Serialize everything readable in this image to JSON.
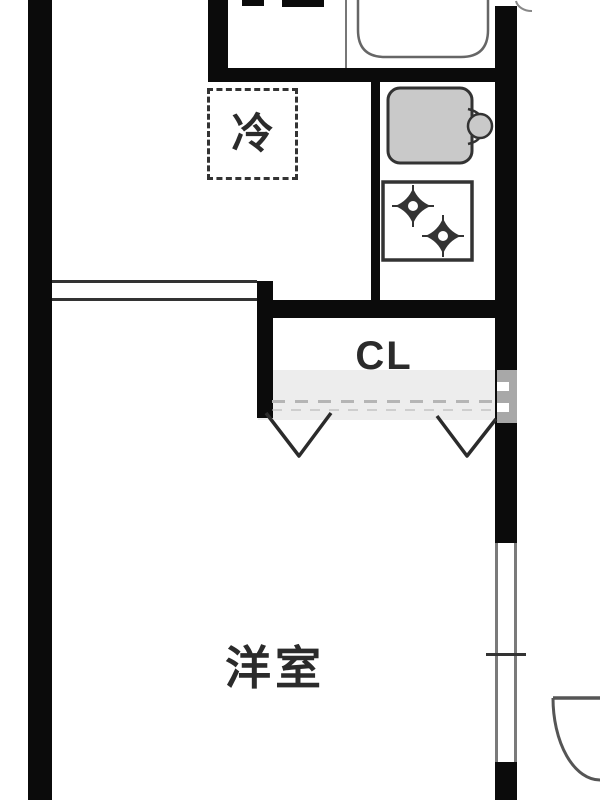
{
  "floorplan": {
    "rooms": {
      "western_room_label": "洋室",
      "closet_label": "CL",
      "refrigerator_label": "冷"
    },
    "fixtures": [
      "washbasin",
      "kitchen-sink",
      "two-burner-stove",
      "refrigerator-space",
      "closet-folding-doors",
      "window",
      "entry-door-swing"
    ],
    "colors": {
      "background": "#ffffff",
      "wall": "#0b0b0b",
      "line": "#333333",
      "text": "#2b2b2b",
      "sink_fill": "#c9c9c9",
      "window_frame": "#7a7a7a",
      "thin_divider": "#777777",
      "closet_dash": "#b5b5b5",
      "watermark": "#a8a8a8",
      "watermark_band": "#ededed",
      "basin_stroke": "#666666",
      "arc_stroke": "#555555"
    }
  }
}
